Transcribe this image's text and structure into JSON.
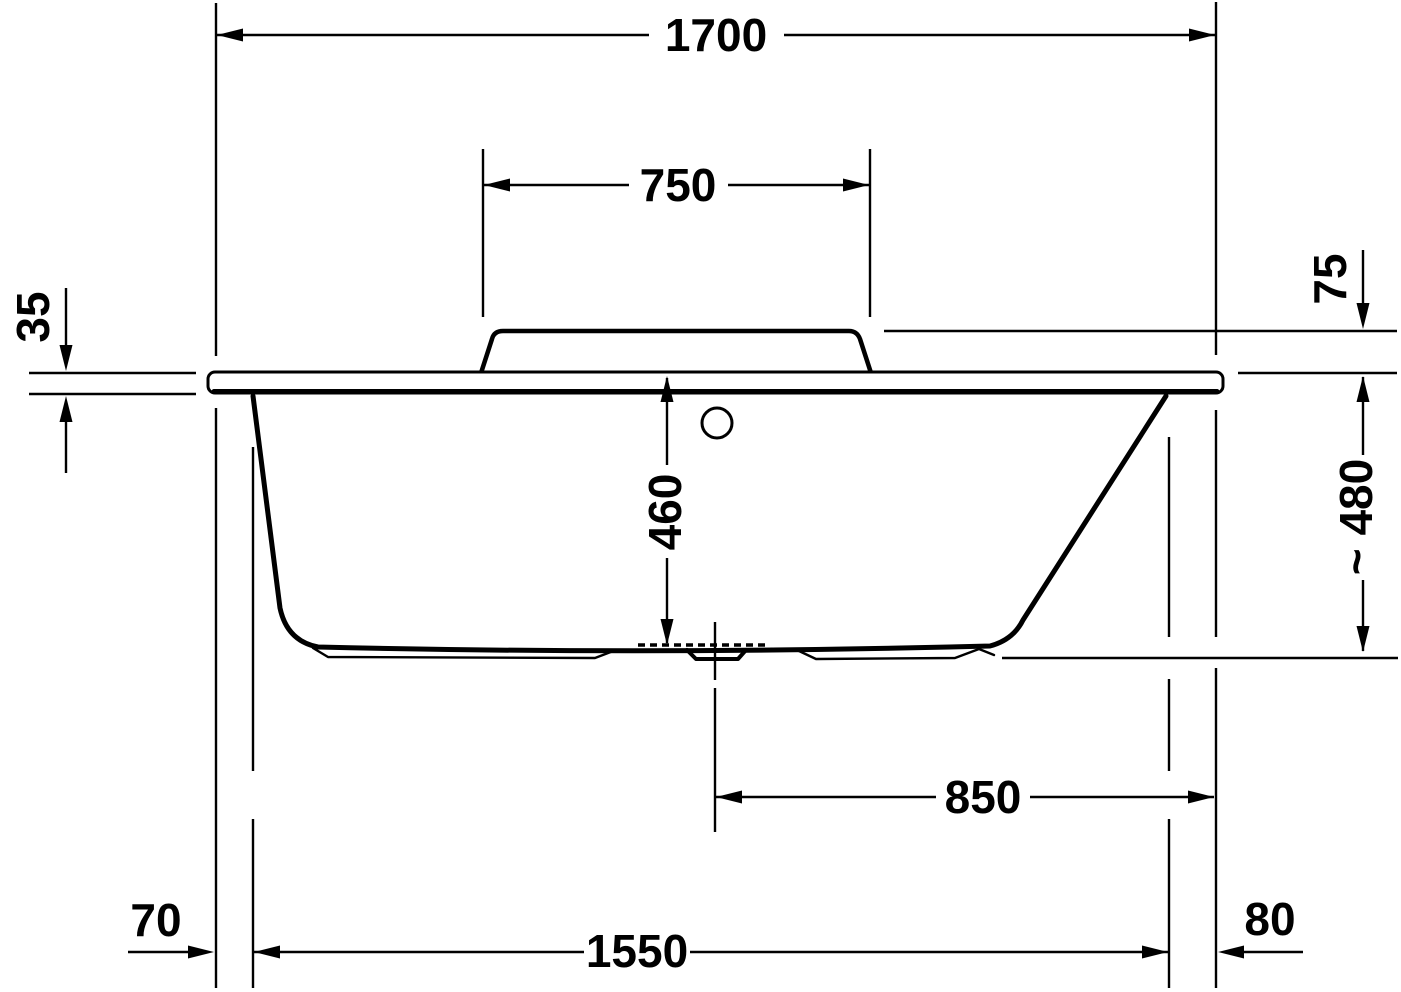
{
  "drawing": {
    "subject": "Bathtub side elevation - dimensioned technical drawing",
    "unit": "mm",
    "background_color": "#ffffff",
    "line_color": "#000000"
  },
  "dimensions": {
    "overall_length": "1700",
    "backrest_width": "750",
    "rim_thickness": "35",
    "deck_to_backrest_top": "75",
    "inner_depth": "460",
    "overall_height": "~ 480",
    "drain_center_to_right_edge": "850",
    "base_offset_left": "70",
    "base_offset_right": "80",
    "base_length": "1550"
  }
}
